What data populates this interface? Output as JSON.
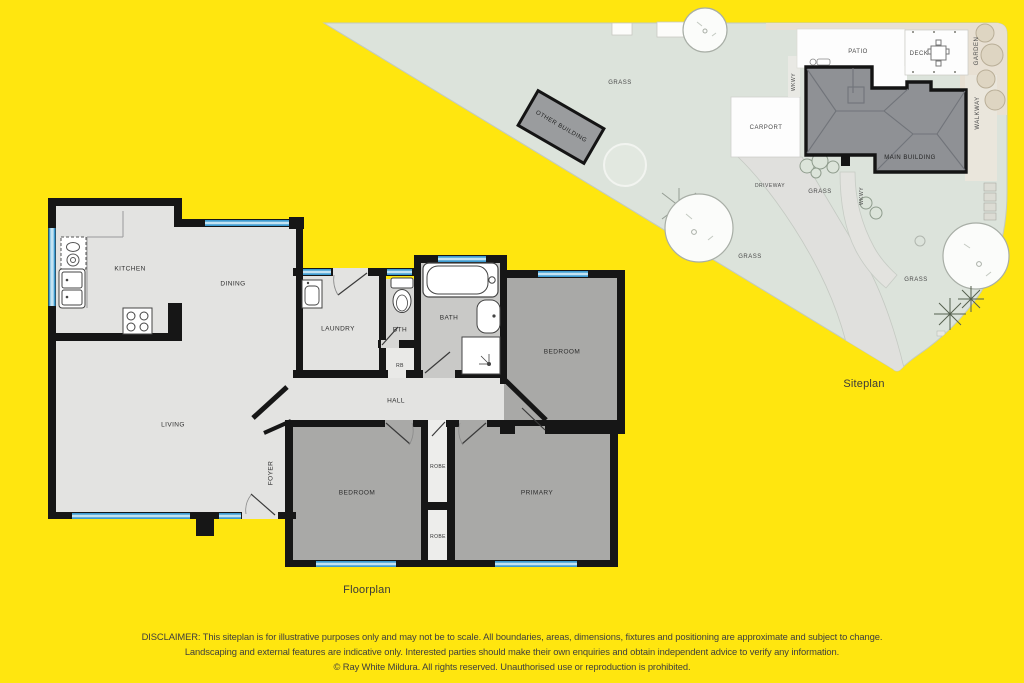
{
  "floorplan": {
    "title": "Floorplan",
    "rooms": {
      "kitchen": "KITCHEN",
      "dining": "DINING",
      "living": "LIVING",
      "foyer": "FOYER",
      "laundry": "LAUNDRY",
      "bth": "BTH",
      "rb": "RB",
      "hall": "HALL",
      "bath": "BATH",
      "bedroom1": "BEDROOM",
      "bedroom2": "BEDROOM",
      "robe1": "ROBE",
      "robe2": "ROBE",
      "primary": "PRIMARY"
    }
  },
  "siteplan": {
    "title": "Siteplan",
    "labels": {
      "grass": "GRASS",
      "driveway": "DRIVEWAY",
      "wkwy": "WKWY",
      "patio": "PATIO",
      "deck": "DECK",
      "garden": "GARDEN",
      "walkway": "WALKWAY",
      "carport": "CARPORT",
      "main_building": "MAIN BUILDING",
      "other_building": "OTHER BUILDING"
    }
  },
  "disclaimer": {
    "line1": "DISCLAIMER: This siteplan is for illustrative purposes only and may not be to scale. All boundaries, areas, dimensions, fixtures and positioning are approximate and subject to change.",
    "line2": "Landscaping and external features are indicative only. Interested parties should make their own enquiries and obtain independent advice to verify any information.",
    "line3": "© Ray White Mildura. All rights reserved. Unauthorised use or reproduction is prohibited."
  },
  "colors": {
    "background": "#ffe60f",
    "wall": "#161616",
    "window_blue": "#3d9bd0",
    "floor_light": "#e3e3e1",
    "floor_dark": "#a9a9a7",
    "grass": "#dce3db",
    "building_gray": "#8f9195"
  }
}
